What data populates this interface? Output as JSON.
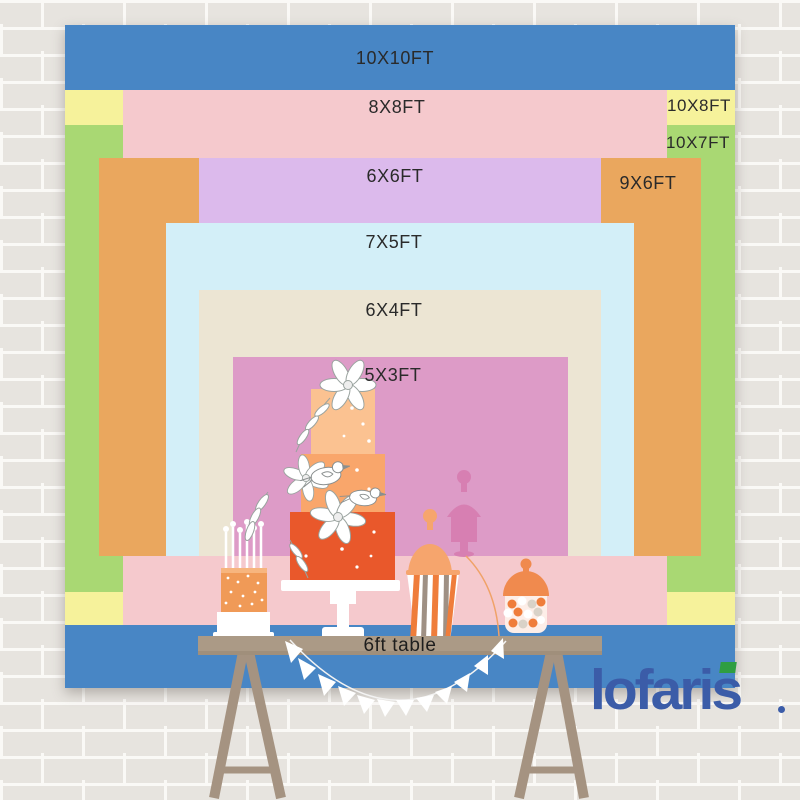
{
  "title": "backdrop size comparison chart",
  "sizes": [
    {
      "label": "10X10FT",
      "color": "#4886c5"
    },
    {
      "label": "8X8FT",
      "color": "#f5c9cd"
    },
    {
      "label": "10X8FT",
      "color": "#f6f29b"
    },
    {
      "label": "10X7FT",
      "color": "#a9d873"
    },
    {
      "label": "6X6FT",
      "color": "#dcbaec"
    },
    {
      "label": "9X6FT",
      "color": "#eaa75e"
    },
    {
      "label": "7X5FT",
      "color": "#d3eff8"
    },
    {
      "label": "6X4FT",
      "color": "#ece5d3"
    },
    {
      "label": "5X3FT",
      "color": "#dd9bc7"
    }
  ],
  "table": {
    "label": "6ft table",
    "color": "#ab9a86"
  },
  "logo": {
    "text": "lofaris",
    "color": "#3b5ca8",
    "accent_color": "#2f9e41"
  },
  "colors": {
    "wall": "#e7e4df",
    "mortar": "#faf9f6",
    "cake_tiers": [
      "#fbc291",
      "#f9a66b",
      "#e9582b"
    ],
    "bunting": "#ffffff"
  },
  "icons": [
    "tiered-cake-icon",
    "candle-cake-icon",
    "popcorn-jar-icon",
    "candy-jar-icon",
    "jar-silhouette-icon",
    "bunting-garland-icon",
    "dessert-table-icon"
  ]
}
